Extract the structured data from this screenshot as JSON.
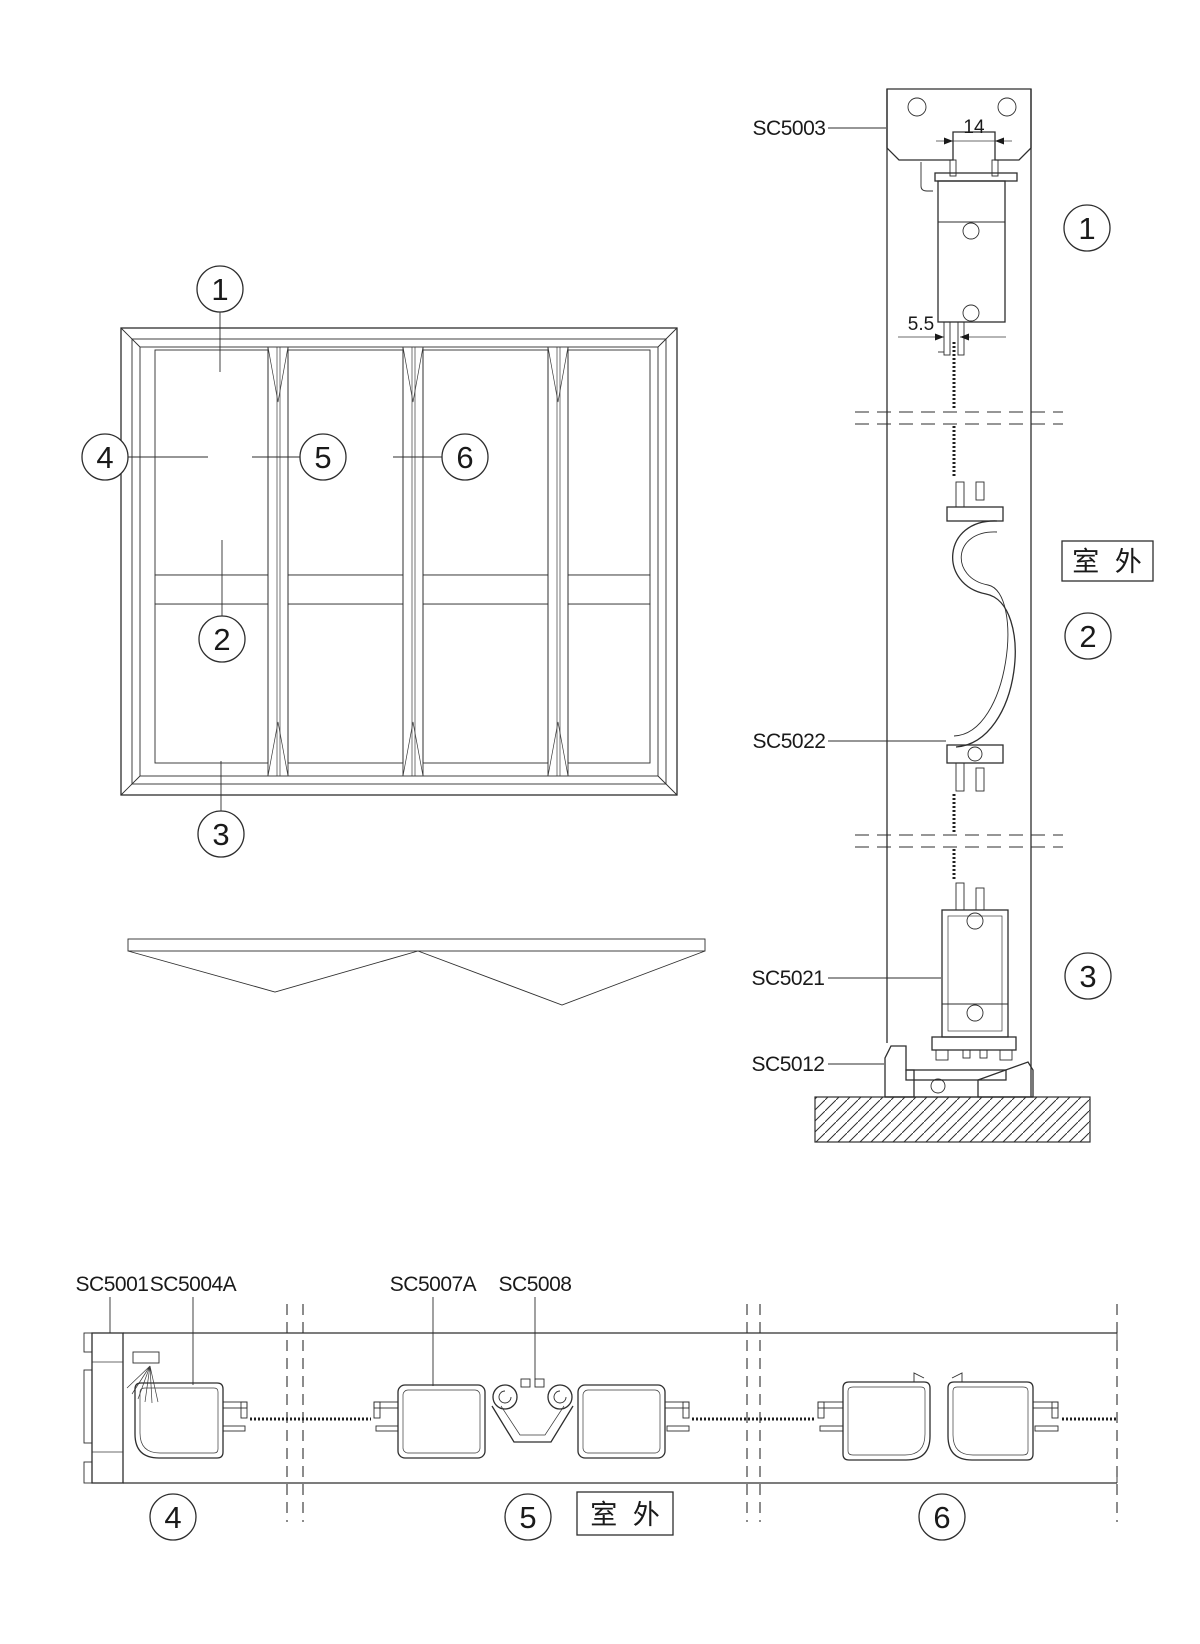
{
  "callouts": {
    "c1": "1",
    "c2": "2",
    "c3": "3",
    "c4": "4",
    "c5": "5",
    "c6": "6"
  },
  "part_labels": {
    "sc5003": "SC5003",
    "sc5022": "SC5022",
    "sc5021": "SC5021",
    "sc5012": "SC5012",
    "sc5001": "SC5001",
    "sc5004a": "SC5004A",
    "sc5007a": "SC5007A",
    "sc5008": "SC5008"
  },
  "dimensions": {
    "track_gap": "14",
    "screen_slot": "5.5"
  },
  "annotations": {
    "outdoor": "室 外"
  }
}
